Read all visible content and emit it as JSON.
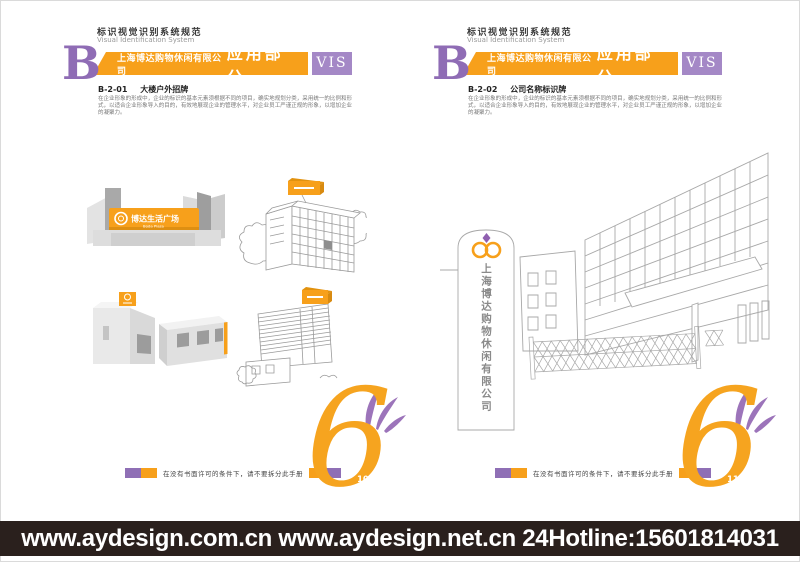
{
  "colors": {
    "orange": "#F7A01B",
    "purple": "#8F6FB5",
    "purple_light": "#A488C6",
    "bar_dark": "#2A201D",
    "sketch_line": "#9B9B9B"
  },
  "pages": [
    {
      "system_title_cn": "标识视觉识别系统规范",
      "system_title_en": "Visual Identification System",
      "index_letter": "B",
      "company_name": "上海博达购物休闲有限公司",
      "section_label": "应用部分",
      "vis_label": "VIS",
      "item_code": "B-2-01",
      "item_title": "大楼户外招牌",
      "body_text": "在企业形象的形成中，企业的标识的基本元素须根据不同的项目，确实地规划分类，采用统一的比例和形式，以适合企业形象导入的目的，有效地展现企业的管理水平，对企业员工严谨正规的形象，以增加企业的凝聚力。",
      "copyright_note": "在没有书面许可的条件下，请不要拆分此手册",
      "chapter_numeral": "6",
      "page_number": "10"
    },
    {
      "system_title_cn": "标识视觉识别系统规范",
      "system_title_en": "Visual Identification System",
      "index_letter": "B",
      "company_name": "上海博达购物休闲有限公司",
      "section_label": "应用部分",
      "vis_label": "VIS",
      "item_code": "B-2-02",
      "item_title": "公司名称标识牌",
      "body_text": "在企业形象的形成中，企业的标识的基本元素须根据不同的项目，确实地规划分类，采用统一的比例和形式，以适合企业形象导入的目的，有效地展现企业的管理水平，对企业员工严谨正规的形象，以增加企业的凝聚力。",
      "copyright_note": "在没有书面许可的条件下，请不要拆分此手册",
      "chapter_numeral": "6",
      "page_number": "11"
    }
  ],
  "illustrations": {
    "plaza_sign_cn": "博达生活广场",
    "plaza_sign_en": "Boda Plaza",
    "pillar_sign_text": "上海博达购物休闲有限公司"
  },
  "bottom_bar": {
    "text": "www.aydesign.com.cn www.aydesign.net.cn 24Hotline:15601814031"
  }
}
